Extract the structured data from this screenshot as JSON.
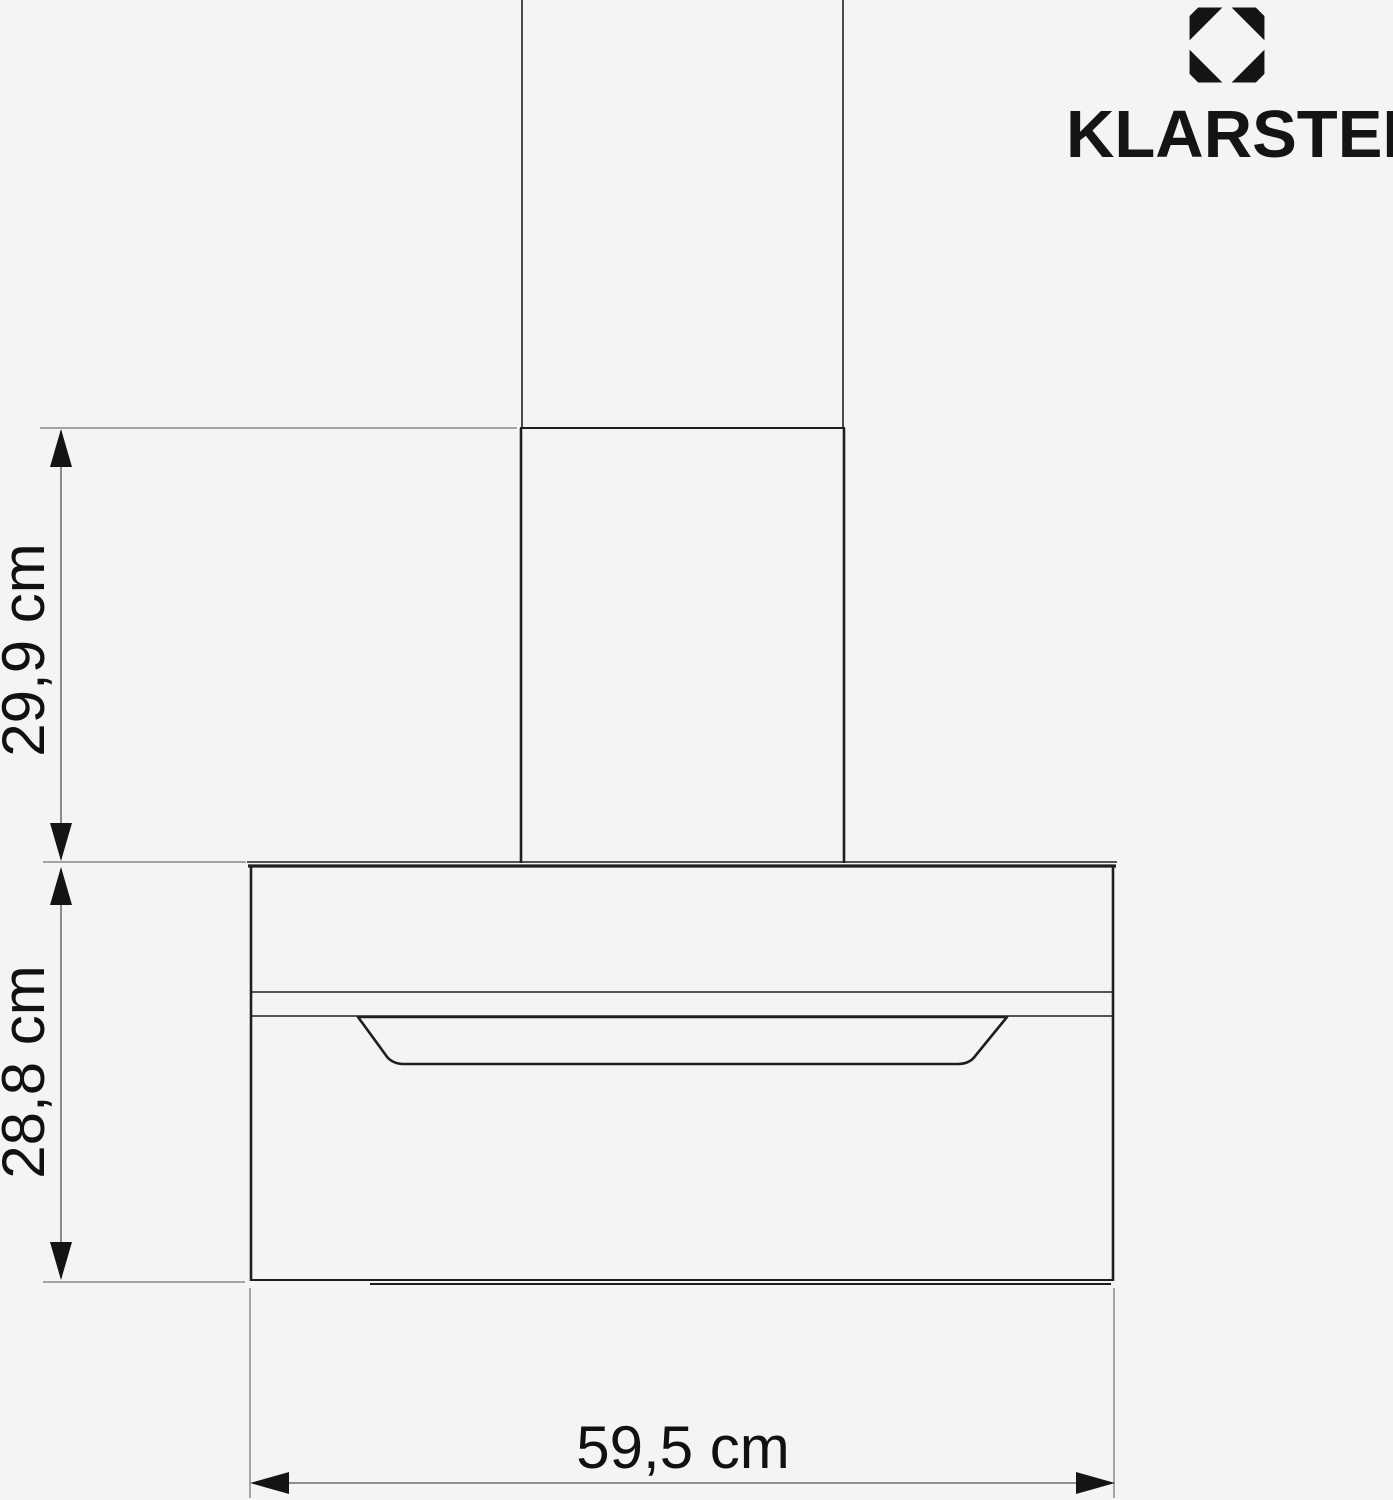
{
  "colors": {
    "background": "#f5f4f2",
    "line_dark": "#1f1f1f",
    "line_gray": "#8a8a8a",
    "arrow": "#141414",
    "text": "#111111",
    "brand": "#141414"
  },
  "brand": {
    "name": "KLARSTEIN",
    "logo_icon": "klarstein-diamond-octagon-icon"
  },
  "diagram": {
    "dimensions": [
      {
        "id": "chimney_height",
        "label": "29,9 cm",
        "orientation": "vertical"
      },
      {
        "id": "body_height",
        "label": "28,8 cm",
        "orientation": "vertical"
      },
      {
        "id": "body_width",
        "label": "59,5 cm",
        "orientation": "horizontal"
      }
    ]
  }
}
